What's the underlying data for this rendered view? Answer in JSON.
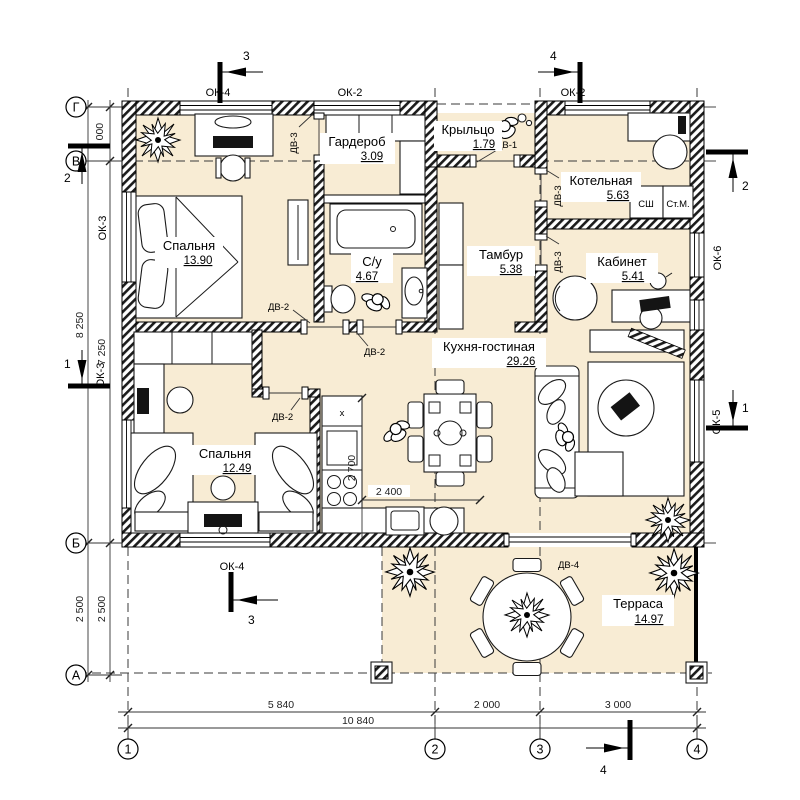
{
  "plan": {
    "colors": {
      "floor": "#f8ecd4",
      "line": "#000000"
    },
    "rooms": [
      {
        "name": "Спальня",
        "area": "13.90"
      },
      {
        "name": "Гардероб",
        "area": "3.09"
      },
      {
        "name": "Крыльцо",
        "area": "1.79"
      },
      {
        "name": "С/у",
        "area": "4.67"
      },
      {
        "name": "Тамбур",
        "area": "5.38"
      },
      {
        "name": "Котельная",
        "area": "5.63"
      },
      {
        "name": "Кабинет",
        "area": "5.41"
      },
      {
        "name": "Кухня-гостиная",
        "area": "29.26"
      },
      {
        "name": "Спальня",
        "area": "12.49"
      },
      {
        "name": "Терраса",
        "area": "14.97"
      }
    ],
    "axis_letters": [
      "Г",
      "В",
      "Б",
      "А"
    ],
    "axis_numbers": [
      "1",
      "2",
      "3",
      "4"
    ],
    "dims": {
      "v1000": "1 000",
      "v8250": "8 250",
      "v7250": "7 250",
      "v2500_outer": "2 500",
      "v2500_inner": "2 500",
      "h5840": "5 840",
      "h2000": "2 000",
      "h3000": "3 000",
      "h10840": "10 840",
      "k2700": "2 700",
      "k2400": "2 400"
    },
    "windows": {
      "ok2": "ОК-2",
      "ok3": "ОК-3",
      "ok4": "ОК-4",
      "ok5": "ОК-5",
      "ok6": "ОК-6"
    },
    "doors": {
      "dv1": "ДВ-1",
      "dv2": "ДВ-2",
      "dv3": "ДВ-3",
      "dv4": "ДВ-4"
    },
    "sections": {
      "s1": "1",
      "s2": "2",
      "s3": "3",
      "s4": "4"
    },
    "equipment": {
      "drying_cabinet": "СШ",
      "washing_machine": "Ст.М.",
      "stove_mark": "х"
    }
  }
}
